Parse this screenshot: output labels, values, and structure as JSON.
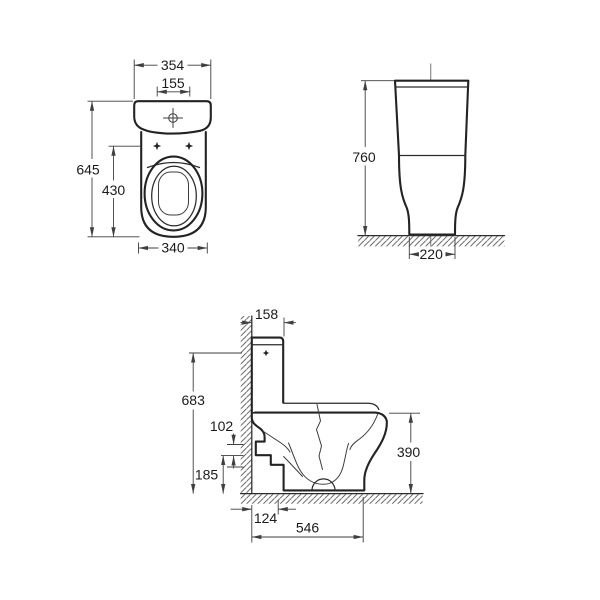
{
  "drawing_colors": {
    "line": "#232323",
    "dim_line": "#3f3f3f",
    "background": "#ffffff"
  },
  "views": {
    "front": {
      "dims": {
        "tank_width": "354",
        "flush_width": "155",
        "total_height": "645",
        "bowl_height": "430",
        "base_width": "340"
      }
    },
    "rear": {
      "dims": {
        "total_height": "760",
        "base_depth": "220"
      }
    },
    "side": {
      "dims": {
        "tank_depth": "158",
        "tank_height": "683",
        "outlet_diameter": "102",
        "outlet_axis_height": "185",
        "outlet_offset": "124",
        "total_depth": "546",
        "rim_height": "390"
      }
    }
  }
}
